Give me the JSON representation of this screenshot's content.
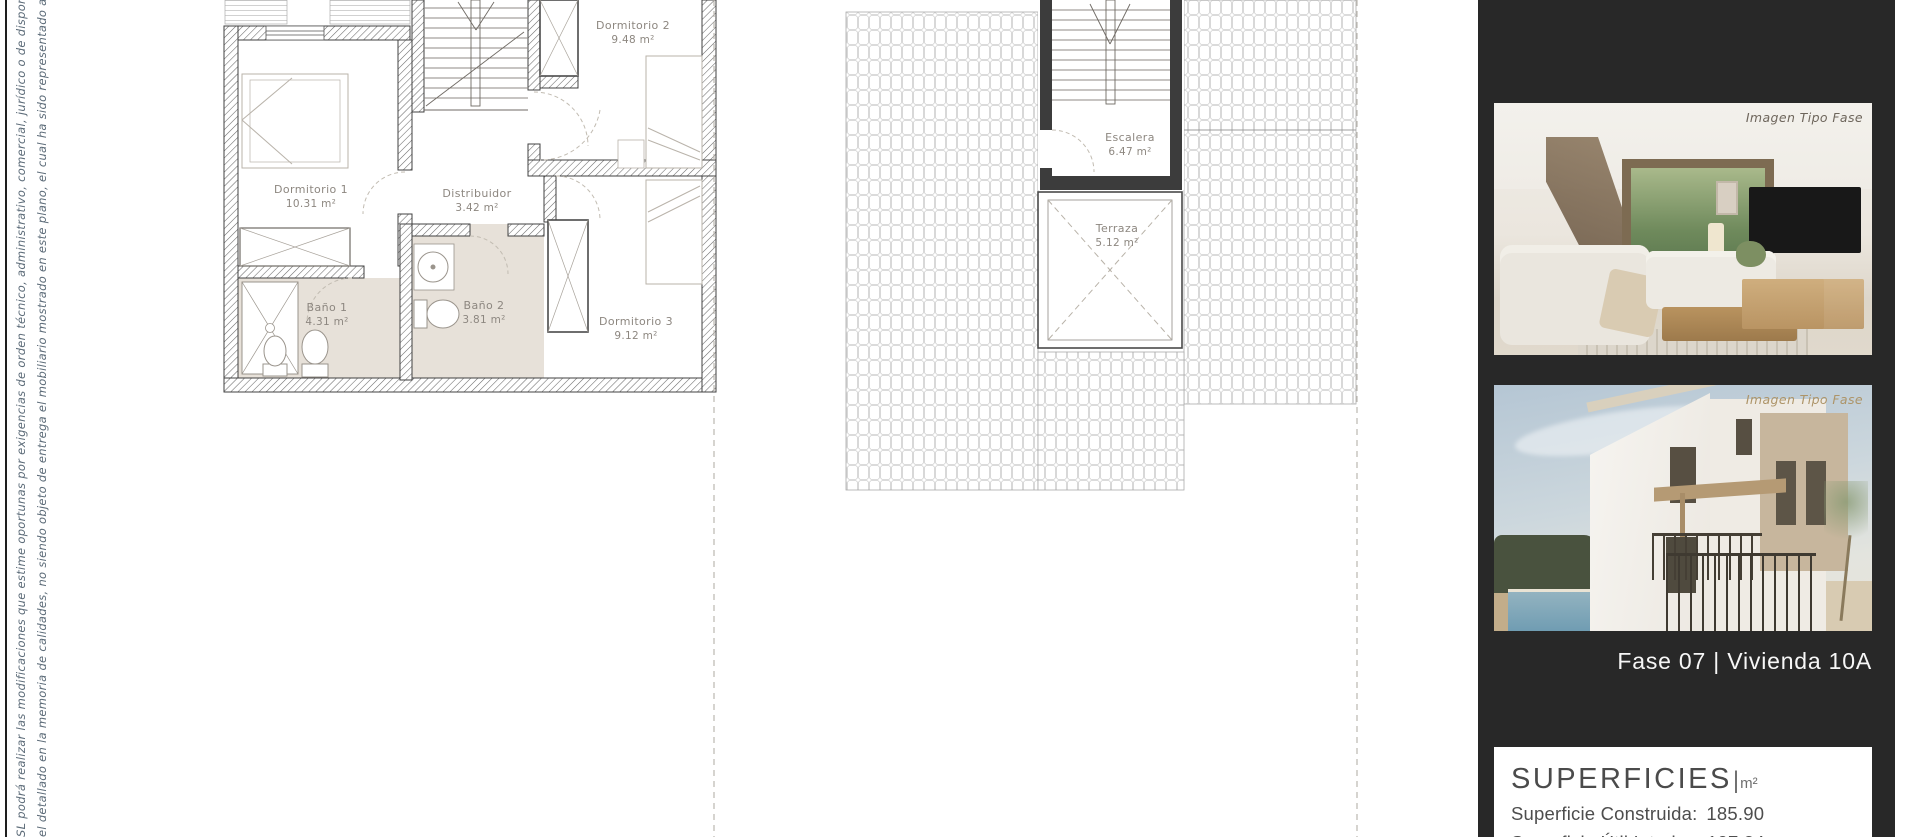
{
  "page": {
    "disclaimer_line1": "SL podrá realizar las modificaciones que estime oportunas por exigencias de orden técnico, administrativo, comercial, jurídico o de disponibilidad. Las superficies",
    "disclaimer_line2": "el detallado en la memoria de calidades, no siendo objeto de entrega el mobiliario mostrado en este plano, el cual ha sido representado a efectos orientativos."
  },
  "floor_plan": {
    "rooms": [
      {
        "name": "Dormitorio 1",
        "area": "10.31 m²"
      },
      {
        "name": "Dormitorio 2",
        "area": "9.48 m²"
      },
      {
        "name": "Dormitorio 3",
        "area": "9.12 m²"
      },
      {
        "name": "Distribuidor",
        "area": "3.42 m²"
      },
      {
        "name": "Baño 1",
        "area": "4.31 m²"
      },
      {
        "name": "Baño 2",
        "area": "3.81 m²"
      }
    ]
  },
  "roof_plan": {
    "rooms": [
      {
        "name": "Escalera",
        "area": "6.47 m²"
      },
      {
        "name": "Terraza",
        "area": "5.12 m²"
      }
    ]
  },
  "sidebar": {
    "image_badge": "Imagen Tipo Fase",
    "project_label": "Fase 07 |  Vivienda 10A",
    "surfaces": {
      "title": "SUPERFICIES",
      "pipe": "|",
      "unit": "m²",
      "rows": [
        {
          "label": "Superficie Construida:",
          "value": "185.90"
        },
        {
          "label": "Superficie Útil Interior:",
          "value": "107.34"
        }
      ]
    },
    "colors": {
      "background": "#282828",
      "badge_tan": "#ad9468"
    }
  }
}
